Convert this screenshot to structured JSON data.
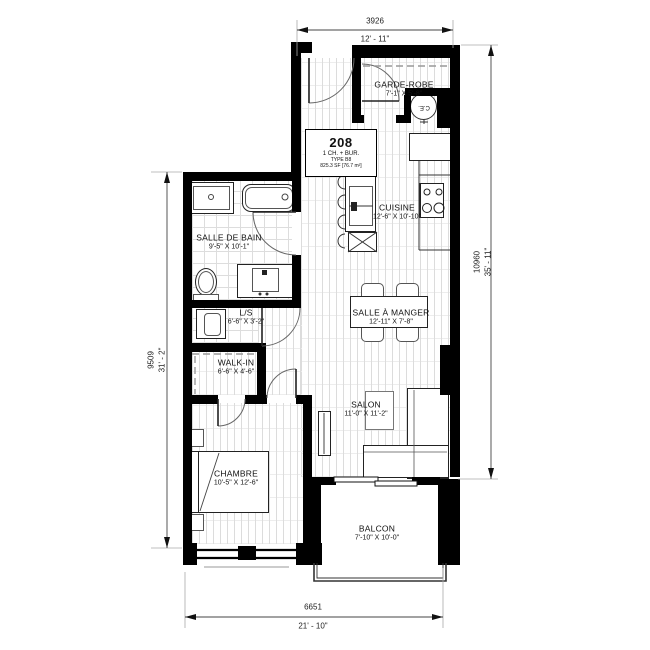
{
  "unit": {
    "number": "208",
    "line1": "1 CH. + BUR.",
    "type": "TYPE B8",
    "area": "825.3 SF [76.7 m²]"
  },
  "rooms": {
    "garde_robe": {
      "name": "GARDE-ROBE",
      "dims": "7'-1\" X 5'-8\""
    },
    "cuisine": {
      "name": "CUISINE",
      "dims": "12'-6\" X 10'-10\""
    },
    "salle_de_bain": {
      "name": "SALLE DE BAIN",
      "dims": "9'-5\" X 10'-1\""
    },
    "ls": {
      "name": "L/S",
      "dims": "6'-6\" X 3'-2\""
    },
    "walk_in": {
      "name": "WALK-IN",
      "dims": "6'-6\" X 4'-6\""
    },
    "salle_a_manger": {
      "name": "SALLE À MANGER",
      "dims": "12'-11\" X 7'-8\""
    },
    "salon": {
      "name": "SALON",
      "dims": "11'-0\" X 11'-2\""
    },
    "chambre": {
      "name": "CHAMBRE",
      "dims": "10'-5\" X 12'-6\""
    },
    "balcon": {
      "name": "BALCON",
      "dims": "7'-10\" X 10'-0\""
    }
  },
  "dimensions": {
    "top": {
      "mm": "3926",
      "ft": "12' - 11\""
    },
    "right": {
      "mm": "10960",
      "ft": "35' - 11\""
    },
    "left": {
      "mm": "9509",
      "ft": "31' - 2\""
    },
    "bottom": {
      "mm": "6651",
      "ft": "21' - 10\""
    }
  },
  "labels": {
    "water_heater": "C.E."
  },
  "colors": {
    "wall": "#000000",
    "linework": "#444444",
    "extension_line": "#aaaaaa",
    "floor_line": "#dcdcdc"
  }
}
